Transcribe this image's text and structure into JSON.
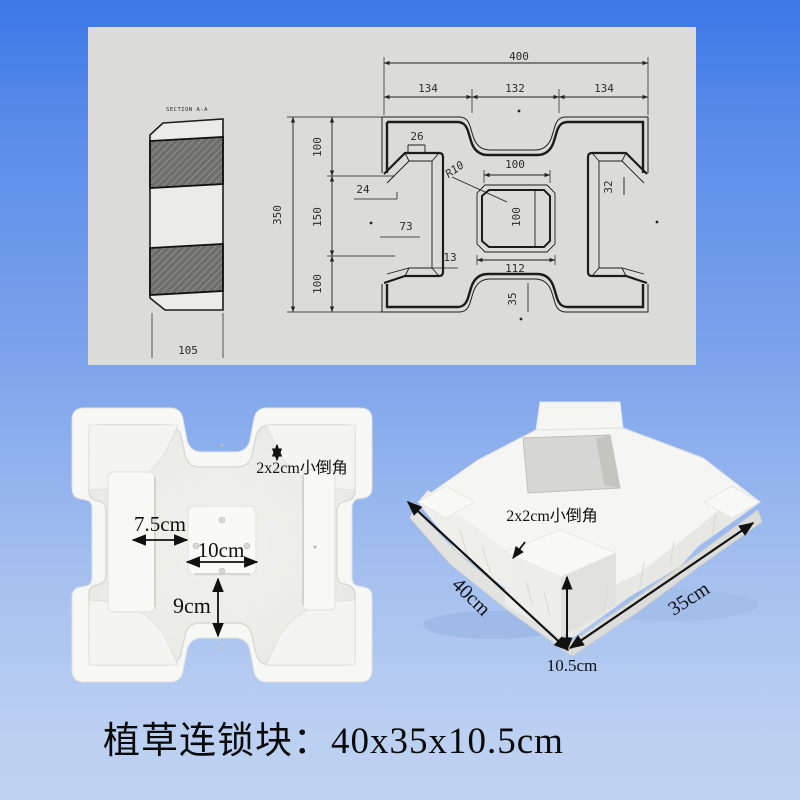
{
  "colors": {
    "bg_top": "#3c78e7",
    "bg_bottom": "#bed1f3",
    "panel": "#dbdbd9",
    "line": "#222222",
    "mold_white": "#f6f6f5"
  },
  "drawing": {
    "section_label": "SECTION A-A",
    "side_width": "105",
    "plan": {
      "overall_w": "400",
      "seg_top": [
        "134",
        "132",
        "134"
      ],
      "overall_h": "350",
      "seg_left": [
        "100",
        "150",
        "100"
      ],
      "d26": "26",
      "d24": "24",
      "d73": "73",
      "d13": "13",
      "r10": "R10",
      "center_w": "100",
      "center_h": "100",
      "center_outer": "112",
      "d32": "32",
      "d35": "35"
    }
  },
  "top_photo": {
    "note": "2x2cm小倒角",
    "dim1": "7.5cm",
    "dim2": "10cm",
    "dim3": "9cm"
  },
  "persp_photo": {
    "note": "2x2cm小倒角",
    "dim_l": "40cm",
    "dim_w": "35cm",
    "dim_h": "10.5cm"
  },
  "caption": "植草连锁块：40x35x10.5cm"
}
